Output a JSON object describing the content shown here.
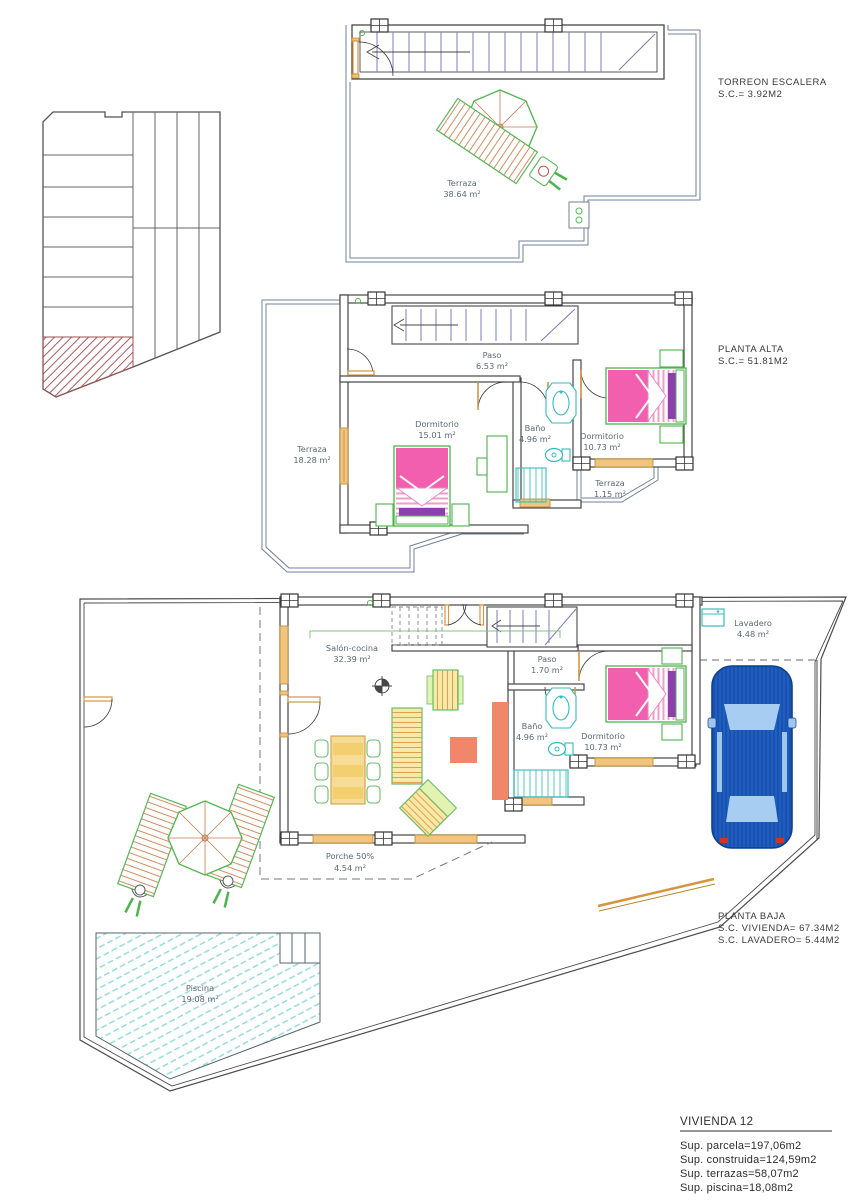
{
  "titles": {
    "torreon": {
      "line1": "TORREON ESCALERA",
      "line2": "S.C.= 3.92M2"
    },
    "alta": {
      "line1": "PLANTA ALTA",
      "line2": "S.C.= 51.81M2"
    },
    "baja": {
      "line1": "PLANTA BAJA",
      "line2": "S.C. VIVIENDA= 67.34M2",
      "line3": "S.C. LAVADERO= 5.44M2"
    }
  },
  "rooms": {
    "torreon_terraza": {
      "name": "Terraza",
      "area": "38.64 m²"
    },
    "alta_paso": {
      "name": "Paso",
      "area": "6.53 m²"
    },
    "alta_dorm1": {
      "name": "Dormitorio",
      "area": "15.01 m²"
    },
    "alta_bano": {
      "name": "Baño",
      "area": "4.96 m²"
    },
    "alta_dorm2": {
      "name": "Dormitorio",
      "area": "10.73 m²"
    },
    "alta_terraza": {
      "name": "Terraza",
      "area": "18.28 m²"
    },
    "alta_terraza2": {
      "name": "Terraza",
      "area": "1.15 m²"
    },
    "baja_salon": {
      "name": "Salón-cocina",
      "area": "32.39 m²"
    },
    "baja_paso": {
      "name": "Paso",
      "area": "1.70 m²"
    },
    "baja_bano": {
      "name": "Baño",
      "area": "4.96 m²"
    },
    "baja_dorm": {
      "name": "Dormitorio",
      "area": "10.73 m²"
    },
    "baja_lavadero": {
      "name": "Lavadero",
      "area": "4.48 m²"
    },
    "baja_porche": {
      "name": "Porche 50%",
      "area": "4.54 m²"
    },
    "piscina": {
      "name": "Piscina",
      "area": "19.08 m²"
    }
  },
  "summary": {
    "title": "VIVIENDA 12",
    "lines": [
      "Sup. parcela=197,06m2",
      "Sup. construida=124,59m2",
      "Sup. terrazas=58,07m2",
      "Sup. piscina=18,08m2"
    ]
  },
  "colors": {
    "wall": "#474747",
    "thin_outline": "#72809c",
    "stair_tread": "#7b7bc0",
    "door": "#d6953f",
    "window_fill": "#f2c57e",
    "furniture_green": "#55b855",
    "bed_pink": "#f25fae",
    "bed_purple": "#8d3fae",
    "fixture_cyan": "#35bcbc",
    "pool_hatch": "#8fd9d9",
    "sofa_yellow": "#f9e9a9",
    "sofa_hatch": "#dfa050",
    "salmon": "#f0876b",
    "car_blue": "#1e5ec2",
    "car_glass": "#a8cdf2",
    "section_hatch_red": "#b05a5a"
  }
}
